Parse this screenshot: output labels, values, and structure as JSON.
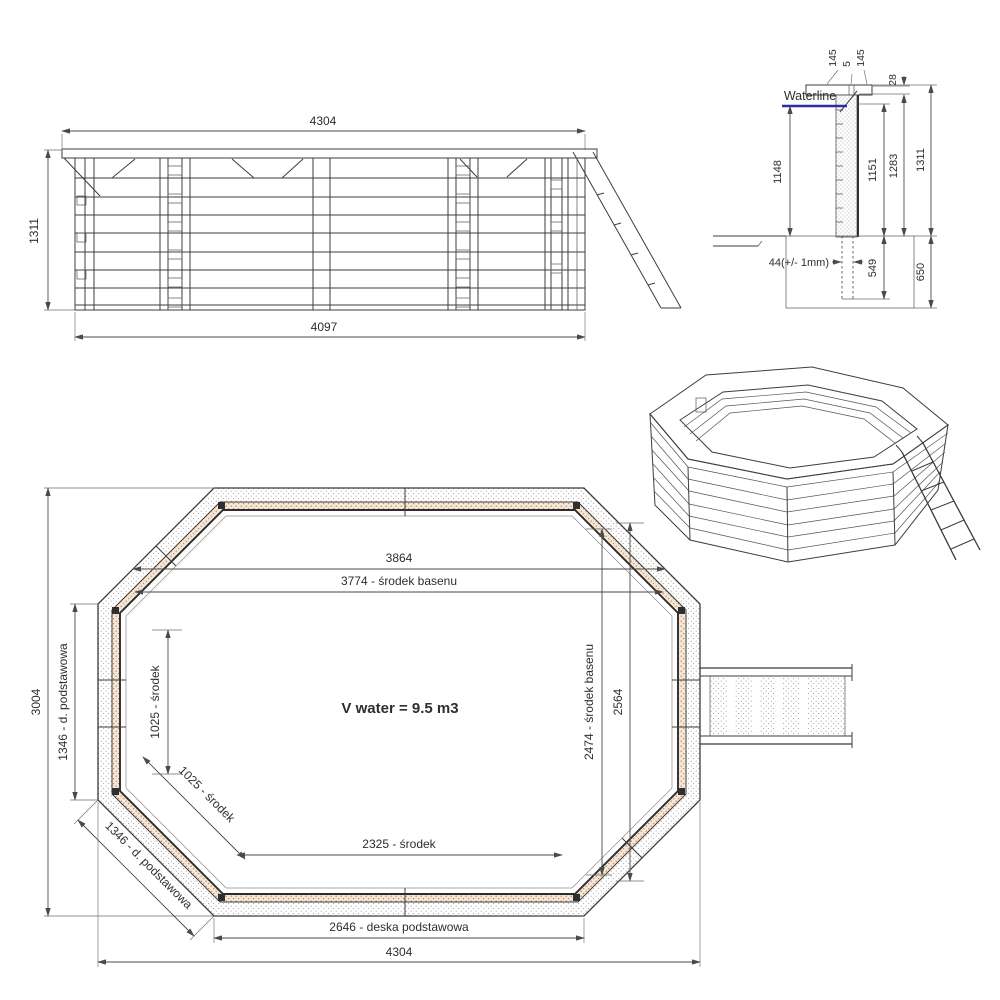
{
  "title": "Wooden octagonal pool technical drawing",
  "colors": {
    "waterline": "#2b2ba6",
    "hatch_orange": "#bf7d52",
    "hatch_bg": "#f5e7d7",
    "hatch_gray": "#9f9f9f"
  },
  "side_view": {
    "dim_top_width": "4304",
    "dim_height": "1311",
    "dim_bottom_width": "4097"
  },
  "section_view": {
    "waterline_label": "Waterline",
    "dim_cap_outer": "145",
    "dim_cap_gap": "5",
    "dim_cap_inner": "145",
    "dim_cap_thickness": "28",
    "dim_waterline_depth": "1148",
    "dim_wall_inner_height": "1151",
    "dim_wall_outer_height": "1283",
    "dim_total_height": "1311",
    "dim_plank_thickness": "44(+/- 1mm)",
    "dim_post_embed": "549",
    "dim_foundation_depth": "650"
  },
  "plan_view": {
    "dim_top_width": "3864",
    "dim_pool_center_width": "3774 - środek basenu",
    "dim_overall_height": "3004",
    "dim_side_board_left": "1346 - d. podstawowa",
    "dim_side_center_left": "1025 - środek",
    "dim_diag_center": "1025 - środek",
    "dim_diag_board": "1346 - d. podstawowa",
    "dim_bottom_center": "2325 - środek",
    "dim_bottom_board": "2646 - deska podstawowa",
    "dim_overall_width": "4304",
    "dim_right_height": "2564",
    "dim_pool_center_height": "2474 - środek basenu",
    "volume_text": "V water = 9.5 m3"
  }
}
